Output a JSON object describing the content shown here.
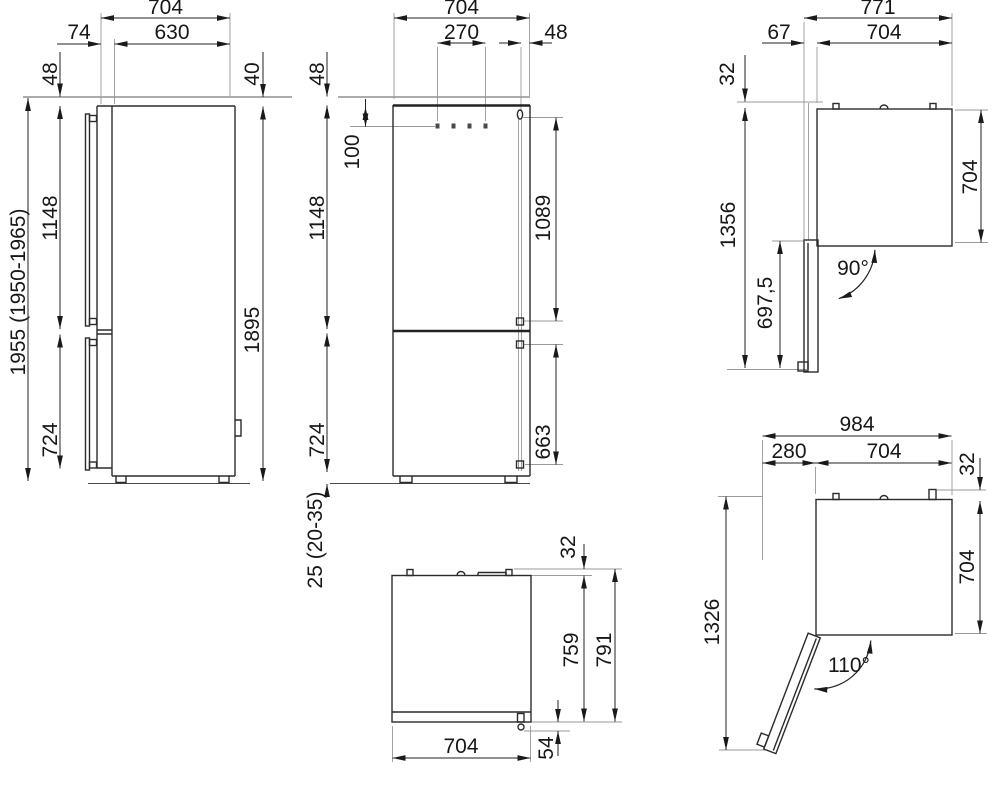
{
  "drawing": {
    "views": {
      "side": {
        "dims": {
          "depth_total": "704",
          "cabinet_depth": "630",
          "door_depth": "74",
          "top_clearance": "48",
          "hinge_clearance": "40",
          "upper_height": "1148",
          "niche_height": "1955 (1950-1965)",
          "overall_height": "1895",
          "lower_height": "724"
        }
      },
      "front": {
        "dims": {
          "width": "704",
          "handle_span": "270",
          "hinge_offset": "48",
          "top_clearance": "48",
          "panel_offset": "100",
          "upper_height": "1148",
          "upper_door_height": "1089",
          "lower_height": "724",
          "lower_door_height": "663",
          "base_gap": "25 (20-35)"
        }
      },
      "top_open_90": {
        "dims": {
          "depth_total": "771",
          "door_thickness": "67",
          "width": "704",
          "rear_clearance": "32",
          "depth_from_wall": "1356",
          "door_span": "697,5",
          "depth": "704",
          "door_angle": "90°"
        }
      },
      "top_closed": {
        "dims": {
          "rear_clearance": "32",
          "body_depth": "759",
          "depth_total": "791",
          "width": "704",
          "hinge_depth": "54"
        }
      },
      "top_open_110": {
        "dims": {
          "width_total": "984",
          "door_projection": "280",
          "width": "704",
          "rear_clearance": "32",
          "depth": "704",
          "depth_open": "1326",
          "door_angle": "110°"
        }
      }
    }
  }
}
